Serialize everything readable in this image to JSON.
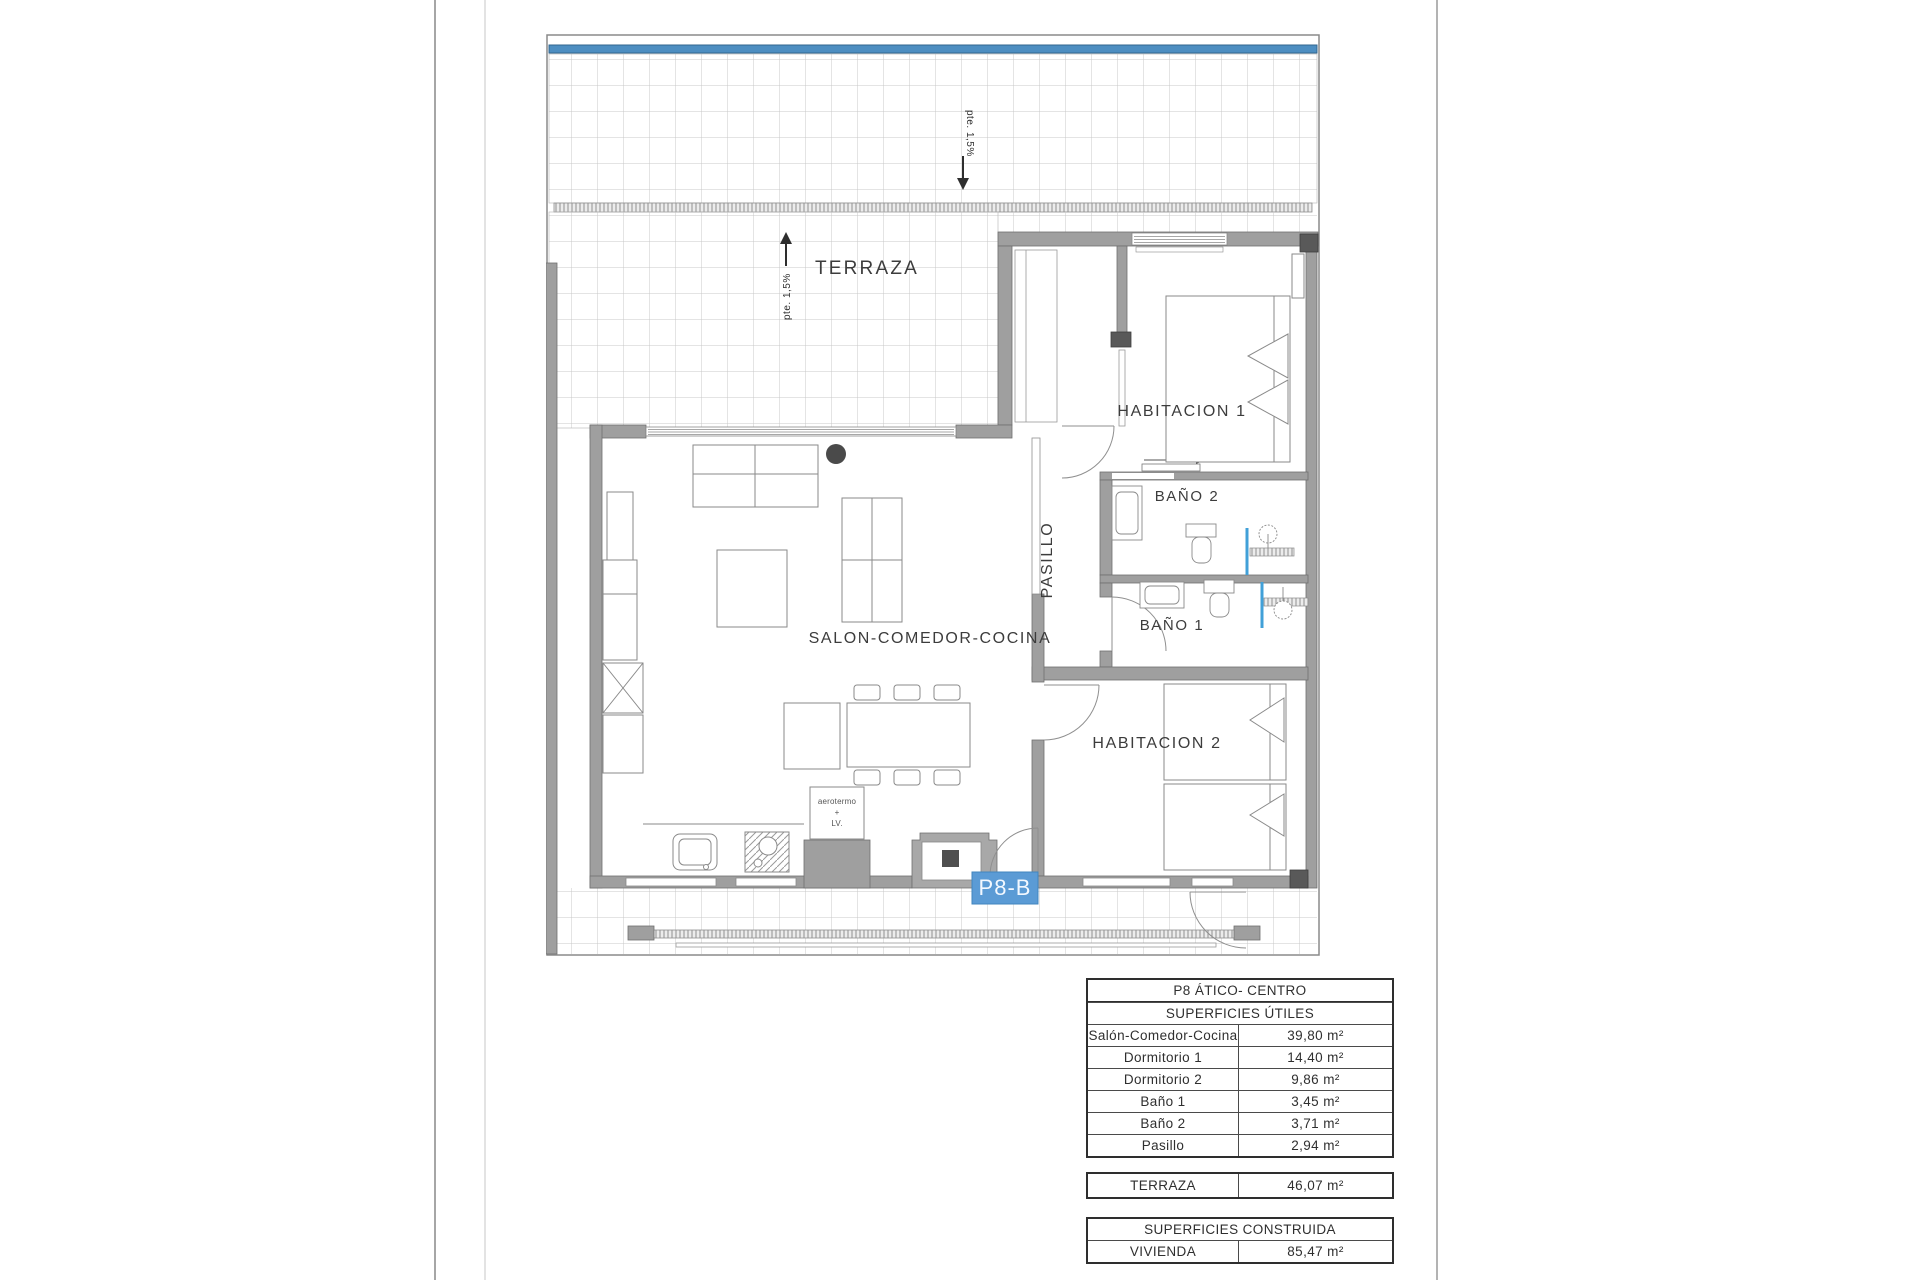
{
  "plan": {
    "terrace_label": "TERRAZA",
    "slope_note_upper": "pte. 1,5%",
    "slope_note_lower": "pte. 1,5%",
    "rooms": {
      "living": "SALON-COMEDOR-COCINA",
      "bedroom1": "HABITACION 1",
      "bedroom2": "HABITACION 2",
      "bath1": "BAÑO 1",
      "bath2": "BAÑO 2",
      "hallway": "PASILLO"
    },
    "unit_badge": "P8-B",
    "appliance_note": {
      "line1": "aerotermo",
      "line2": "+",
      "line3": "LV."
    },
    "colors": {
      "badge_blue": "#5b9bd5",
      "balustrade_blue": "#4d8ec1",
      "shower_blue": "#41a0d8",
      "wall_gray": "#9f9f9f"
    }
  },
  "tables": {
    "title": "P8 ÁTICO- CENTRO",
    "useful": {
      "header": "SUPERFICIES ÚTILES",
      "rows": [
        {
          "label": "Salón-Comedor-Cocina",
          "value": "39,80 m²"
        },
        {
          "label": "Dormitorio 1",
          "value": "14,40 m²"
        },
        {
          "label": "Dormitorio 2",
          "value": "9,86 m²"
        },
        {
          "label": "Baño 1",
          "value": "3,45 m²"
        },
        {
          "label": "Baño 2",
          "value": "3,71 m²"
        },
        {
          "label": "Pasillo",
          "value": "2,94 m²"
        }
      ]
    },
    "terrace": {
      "label": "TERRAZA",
      "value": "46,07 m²"
    },
    "built": {
      "header": "SUPERFICIES CONSTRUIDA",
      "rows": [
        {
          "label": "VIVIENDA",
          "value": "85,47 m²"
        }
      ]
    }
  }
}
